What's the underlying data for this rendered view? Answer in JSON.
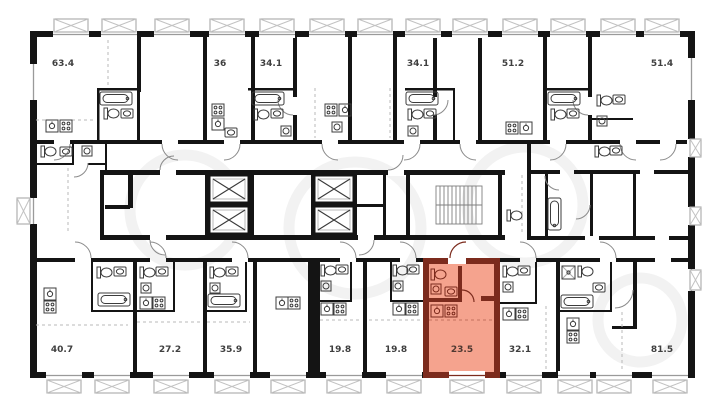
{
  "plan": {
    "type": "apartment-floor-plan",
    "top_units": [
      {
        "area": "63.4"
      },
      {
        "area": "36"
      },
      {
        "area": "34.1"
      },
      {
        "area": "34.1"
      },
      {
        "area": "51.2"
      },
      {
        "area": "51.4"
      }
    ],
    "bottom_units": [
      {
        "area": "40.7"
      },
      {
        "area": "27.2"
      },
      {
        "area": "35.9"
      },
      {
        "area": "19.8"
      },
      {
        "area": "19.8"
      },
      {
        "area": "23.5"
      },
      {
        "area": "32.1"
      },
      {
        "area": "81.5"
      }
    ],
    "highlighted_unit": {
      "area": "23.5",
      "row": "bottom",
      "index": 5
    },
    "colors": {
      "wall": "#141414",
      "highlight-fill": "#f5a38e",
      "highlight-wall": "#7c2b1d",
      "highlight-line": "#c4705f",
      "fixture-line": "#3c3c3c",
      "light-line": "#9a9a9a",
      "label": "#3f3f3f",
      "watermark": "#f2f2f2"
    }
  }
}
